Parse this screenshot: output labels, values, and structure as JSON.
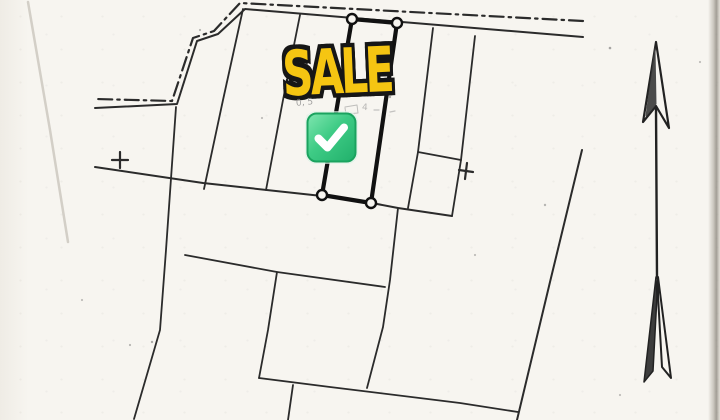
{
  "document": {
    "kind": "scanned cadastral land-plot sketch with sale overlay"
  },
  "overlay": {
    "sale_label": "SALE",
    "sale_fill_color": "#F5C512",
    "sale_outline_color": "#161616",
    "check_icon": "white-check-mark-emoji",
    "check_green_top": "#7fe6b0",
    "check_green_bottom": "#21b06b",
    "check_border": "#1ba35f"
  },
  "pencil_notes": {
    "left_note": "0, 5",
    "right_note": "4"
  },
  "plan": {
    "ink_color": "#2b2b2b",
    "paper_color": "#f7f5f0",
    "north_arrow_icon": "north-arrow",
    "shapes": [
      {
        "n": "road-edge-dashdot-line",
        "t": "pl",
        "p": [
          [
            583,
            21
          ],
          [
            240,
            3
          ],
          [
            214,
            31
          ],
          [
            193,
            38
          ],
          [
            172,
            101
          ],
          [
            95,
            99
          ]
        ],
        "sw": 2.2,
        "dash": "14 5 2.5 5"
      },
      {
        "n": "road-edge-solid-line",
        "t": "pl",
        "p": [
          [
            583,
            37
          ],
          [
            245,
            9
          ],
          [
            218,
            34
          ],
          [
            197,
            41
          ],
          [
            177,
            104
          ],
          [
            95,
            108
          ]
        ],
        "sw": 2
      },
      {
        "n": "boundary-divider-1",
        "t": "pl",
        "p": [
          [
            243,
            9
          ],
          [
            223,
            100
          ],
          [
            204,
            189
          ]
        ]
      },
      {
        "n": "boundary-divider-2",
        "t": "pl",
        "p": [
          [
            300,
            15
          ],
          [
            283,
            100
          ],
          [
            266,
            190
          ]
        ]
      },
      {
        "n": "boundary-divider-3",
        "t": "pl",
        "p": [
          [
            433,
            28
          ],
          [
            418,
            152
          ],
          [
            408,
            208
          ]
        ]
      },
      {
        "n": "boundary-divider-4",
        "t": "pl",
        "p": [
          [
            475,
            36
          ],
          [
            461,
            160
          ]
        ]
      },
      {
        "n": "boundary-main-south",
        "t": "pl",
        "p": [
          [
            95,
            167
          ],
          [
            203,
            183
          ],
          [
            322,
            196
          ],
          [
            372,
            203
          ],
          [
            398,
            208
          ],
          [
            452,
            216
          ]
        ],
        "sw": 2
      },
      {
        "n": "small-plot-outline",
        "t": "pl",
        "p": [
          [
            418,
            152
          ],
          [
            461,
            160
          ],
          [
            452,
            216
          ]
        ]
      },
      {
        "n": "boundary-west-long",
        "t": "pl",
        "p": [
          [
            176,
            107
          ],
          [
            166,
            250
          ],
          [
            160,
            330
          ],
          [
            134,
            419
          ]
        ]
      },
      {
        "n": "boundary-middle-horizontal",
        "t": "pl",
        "p": [
          [
            185,
            255
          ],
          [
            277,
            272
          ],
          [
            385,
            287
          ]
        ]
      },
      {
        "n": "boundary-middle-vertical",
        "t": "pl",
        "p": [
          [
            398,
            208
          ],
          [
            390,
            280
          ],
          [
            383,
            327
          ],
          [
            367,
            388
          ]
        ]
      },
      {
        "n": "boundary-lower-vertical",
        "t": "pl",
        "p": [
          [
            277,
            272
          ],
          [
            268,
            330
          ],
          [
            259,
            378
          ]
        ]
      },
      {
        "n": "boundary-bottom-horizontal",
        "t": "pl",
        "p": [
          [
            259,
            378
          ],
          [
            330,
            387
          ],
          [
            460,
            403
          ],
          [
            518,
            412
          ]
        ]
      },
      {
        "n": "boundary-bottom-stub",
        "t": "pl",
        "p": [
          [
            293,
            385
          ],
          [
            288,
            420
          ]
        ]
      },
      {
        "n": "boundary-east-diagonal",
        "t": "pl",
        "p": [
          [
            582,
            150
          ],
          [
            550,
            282
          ],
          [
            517,
            420
          ]
        ],
        "sw": 2
      },
      {
        "n": "sale-plot-outline",
        "t": "pg",
        "p": [
          [
            352,
            19
          ],
          [
            397,
            23
          ],
          [
            371,
            203
          ],
          [
            322,
            195
          ]
        ],
        "sw": 4.2,
        "s": "#111111"
      },
      {
        "n": "sale-plot-corner-marker",
        "t": "c",
        "c": [
          352,
          19
        ],
        "r": 5,
        "sw": 2.4,
        "s": "#111111",
        "f": "#f7f5f0"
      },
      {
        "n": "sale-plot-corner-marker",
        "t": "c",
        "c": [
          397,
          23
        ],
        "r": 5,
        "sw": 2.4,
        "s": "#111111",
        "f": "#f7f5f0"
      },
      {
        "n": "sale-plot-corner-marker",
        "t": "c",
        "c": [
          322,
          195
        ],
        "r": 5,
        "sw": 2.4,
        "s": "#111111",
        "f": "#f7f5f0"
      },
      {
        "n": "sale-plot-corner-marker",
        "t": "c",
        "c": [
          371,
          203
        ],
        "r": 5,
        "sw": 2.4,
        "s": "#111111",
        "f": "#f7f5f0"
      },
      {
        "n": "survey-plus-mark",
        "t": "pl",
        "p": [
          [
            112,
            160
          ],
          [
            128,
            160
          ]
        ],
        "sw": 2.2
      },
      {
        "n": "survey-plus-mark",
        "t": "pl",
        "p": [
          [
            120,
            152
          ],
          [
            120,
            168
          ]
        ],
        "sw": 2.2
      },
      {
        "n": "survey-plus-mark",
        "t": "pl",
        "p": [
          [
            459,
            170
          ],
          [
            473,
            172
          ]
        ],
        "sw": 2.2
      },
      {
        "n": "survey-plus-mark",
        "t": "pl",
        "p": [
          [
            467,
            163
          ],
          [
            465,
            179
          ]
        ],
        "sw": 2.2
      },
      {
        "n": "north-arrow-head-outline",
        "t": "pg",
        "p": [
          [
            656,
            42
          ],
          [
            643,
            122
          ],
          [
            656,
            106
          ],
          [
            669,
            128
          ]
        ],
        "sw": 2.2,
        "s": "#222222"
      },
      {
        "n": "north-arrow-head-fill",
        "t": "pg",
        "p": [
          [
            655,
            48
          ],
          [
            646,
            116
          ],
          [
            656,
            104
          ]
        ],
        "f": "#3d3d3d",
        "s": "#3d3d3d",
        "sw": 1,
        "op": 0.92
      },
      {
        "n": "north-arrow-shaft",
        "t": "pl",
        "p": [
          [
            656,
            108
          ],
          [
            657,
            278
          ]
        ],
        "sw": 2.4,
        "s": "#222222"
      },
      {
        "n": "north-arrow-fletch-left",
        "t": "pg",
        "p": [
          [
            656,
            277
          ],
          [
            644,
            382
          ],
          [
            653,
            371
          ],
          [
            657,
            296
          ]
        ],
        "f": "#3d3d3d",
        "s": "#222222",
        "sw": 1.5
      },
      {
        "n": "north-arrow-fletch-right",
        "t": "pg",
        "p": [
          [
            658,
            277
          ],
          [
            671,
            378
          ],
          [
            662,
            367
          ],
          [
            658,
            296
          ]
        ],
        "s": "#222222",
        "sw": 2
      },
      {
        "n": "scan-crease",
        "t": "pl",
        "p": [
          [
            28,
            2
          ],
          [
            50,
            130
          ],
          [
            68,
            242
          ]
        ],
        "s": "#cdc8bf",
        "sw": 2.5,
        "op": 0.85
      },
      {
        "n": "pencil-scribble",
        "t": "pl",
        "p": [
          [
            345,
            107
          ],
          [
            357,
            105
          ],
          [
            358,
            113
          ],
          [
            346,
            114
          ],
          [
            345,
            108
          ]
        ],
        "s": "#8f8f8f",
        "sw": 1,
        "op": 0.55
      },
      {
        "n": "pencil-scribble",
        "t": "pl",
        "p": [
          [
            374,
            110
          ],
          [
            379,
            110
          ]
        ],
        "s": "#8f8f8f",
        "sw": 1.2,
        "op": 0.5
      },
      {
        "n": "pencil-scribble",
        "t": "pl",
        "p": [
          [
            390,
            112
          ],
          [
            395,
            111
          ]
        ],
        "s": "#8f8f8f",
        "sw": 1.2,
        "op": 0.5
      },
      {
        "n": "pencil-scribble",
        "t": "pl",
        "p": [
          [
            313,
            96
          ],
          [
            317,
            91
          ],
          [
            321,
            96
          ]
        ],
        "s": "#9a9a9a",
        "sw": 1,
        "op": 0.4
      },
      {
        "n": "scan-speck",
        "t": "c",
        "c": [
          610,
          48
        ],
        "r": 1.3,
        "f": "#555555",
        "s": "none",
        "op": 0.5
      },
      {
        "n": "scan-speck",
        "t": "c",
        "c": [
          390,
          97
        ],
        "r": 1.2,
        "f": "#555555",
        "s": "none",
        "op": 0.45
      },
      {
        "n": "scan-speck",
        "t": "c",
        "c": [
          152,
          342
        ],
        "r": 1.2,
        "f": "#555555",
        "s": "none",
        "op": 0.45
      },
      {
        "n": "scan-speck",
        "t": "c",
        "c": [
          200,
          30
        ],
        "r": 1.1,
        "f": "#555555",
        "s": "none",
        "op": 0.4
      },
      {
        "n": "scan-speck",
        "t": "c",
        "c": [
          545,
          205
        ],
        "r": 1.2,
        "f": "#555555",
        "s": "none",
        "op": 0.4
      },
      {
        "n": "scan-speck",
        "t": "c",
        "c": [
          82,
          300
        ],
        "r": 1.1,
        "f": "#555555",
        "s": "none",
        "op": 0.35
      },
      {
        "n": "scan-speck",
        "t": "c",
        "c": [
          620,
          395
        ],
        "r": 1.1,
        "f": "#555555",
        "s": "none",
        "op": 0.35
      },
      {
        "n": "scan-speck",
        "t": "c",
        "c": [
          262,
          118
        ],
        "r": 1.1,
        "f": "#555555",
        "s": "none",
        "op": 0.35
      },
      {
        "n": "scan-speck",
        "t": "c",
        "c": [
          130,
          345
        ],
        "r": 1.1,
        "f": "#555555",
        "s": "none",
        "op": 0.4
      },
      {
        "n": "scan-speck",
        "t": "c",
        "c": [
          700,
          62
        ],
        "r": 1.1,
        "f": "#555555",
        "s": "none",
        "op": 0.35
      },
      {
        "n": "scan-speck",
        "t": "c",
        "c": [
          475,
          255
        ],
        "r": 1.1,
        "f": "#555555",
        "s": "none",
        "op": 0.35
      }
    ]
  }
}
